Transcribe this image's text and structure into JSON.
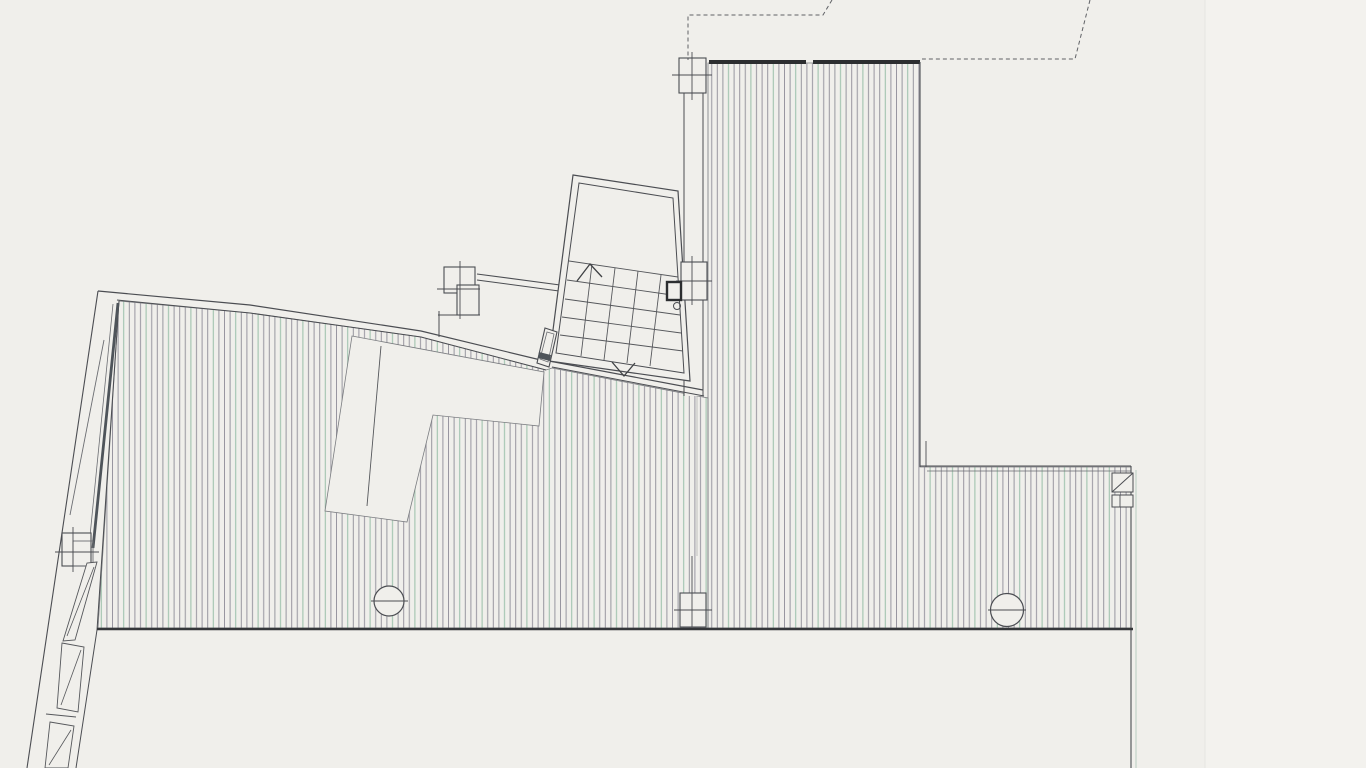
{
  "page": {
    "title": "Scanned architectural floor plan - deck level with stair",
    "background": "#f0efeb",
    "width": 1366,
    "height": 768,
    "visible_text": []
  },
  "palette": {
    "paper": "#f0efeb",
    "paper_right_strip": "#f3f2ee",
    "ink": "#4b4d52",
    "ink_dark": "#2c2e30",
    "ink_soft": "#6b6d72",
    "hatch_gray": "#8e8c97",
    "hatch_green": "#8fb9a1",
    "beam_dark": "#4e545a",
    "dash_line": "#606266",
    "bottom_edge": "#35373a"
  },
  "hatch": {
    "spacing": 5.6,
    "period": 4,
    "green_index": 2,
    "gray": "#8e8c97",
    "green": "#8fb9a1",
    "line_width": 1,
    "opacity": 0.9
  },
  "elements": [
    {
      "n": "paper-right-strip",
      "t": "rect",
      "x": 1205,
      "y": 0,
      "w": 161,
      "h": 768,
      "f": "#f3f2ee"
    },
    {
      "n": "paper-strip-edge",
      "t": "line",
      "pts": [
        1205,
        0,
        1205,
        768
      ],
      "s": "#e6e5e1",
      "sw": 1
    },
    {
      "n": "deck-right-hatch",
      "t": "path",
      "d": "M708,63 L920,63 L920,467 L1131,467 L1131,628 L708,628 Z",
      "f": "url(#hatch)",
      "s": "#7a7c80",
      "sw": 0.8
    },
    {
      "n": "deck-left-hatch",
      "t": "path",
      "d": "M119,301 L250,313 L421,337 L546,370 L552,368 L708,398 L708,628 L98,628 Z M352,336 L544,372 L539,426 L433,415 L407,522 L325,511 Z",
      "f": "url(#hatch)",
      "s": "#7a7c80",
      "sw": 0.8,
      "fr": "evenodd"
    },
    {
      "n": "void-diagonal-line",
      "t": "line",
      "pts": [
        381,
        346,
        367,
        506
      ],
      "s": "#55575b",
      "sw": 0.9
    },
    {
      "n": "mid-wall-cavity",
      "t": "rect",
      "x": 684,
      "y": 62,
      "w": 19,
      "h": 334,
      "f": "#f0efeb"
    },
    {
      "n": "mid-wall-left-line",
      "t": "line",
      "pts": [
        684,
        62,
        684,
        396
      ],
      "s": "#4b4d52",
      "sw": 1
    },
    {
      "n": "mid-wall-right-line",
      "t": "line",
      "pts": [
        703,
        62,
        703,
        396
      ],
      "s": "#4b4d52",
      "sw": 1
    },
    {
      "n": "mid-wall-lower-line",
      "t": "line",
      "pts": [
        697,
        396,
        697,
        556
      ],
      "s": "#7a7c80",
      "sw": 0.7,
      "o": 0.6
    },
    {
      "n": "top-edge-outer-line",
      "t": "pline",
      "pts": [
        98,
        291,
        250,
        305,
        421,
        331,
        549,
        362
      ],
      "s": "#4b4d52",
      "sw": 1.2
    },
    {
      "n": "top-edge-inner-line",
      "t": "pline",
      "pts": [
        117,
        300,
        250,
        313,
        421,
        337,
        546,
        370
      ],
      "s": "#4b4d52",
      "sw": 1
    },
    {
      "n": "stair-bottom-wall-outer",
      "t": "line",
      "pts": [
        549,
        361,
        703,
        390
      ],
      "s": "#4b4d52",
      "sw": 1.2
    },
    {
      "n": "stair-bottom-wall-inner",
      "t": "line",
      "pts": [
        552,
        367,
        704,
        396
      ],
      "s": "#4b4d52",
      "sw": 1
    },
    {
      "n": "left-wall-outer-line",
      "t": "line",
      "pts": [
        98,
        291,
        27,
        768
      ],
      "s": "#4b4d52",
      "sw": 1.1
    },
    {
      "n": "left-wall-inner-line",
      "t": "pline",
      "pts": [
        119,
        301,
        97,
        630,
        76,
        768
      ],
      "s": "#4b4d52",
      "sw": 1
    },
    {
      "n": "left-wall-beam",
      "t": "line",
      "pts": [
        118,
        303,
        93,
        548
      ],
      "s": "#4e545a",
      "sw": 2.8
    },
    {
      "n": "left-wall-beam-edge",
      "t": "line",
      "pts": [
        113,
        304,
        89,
        546
      ],
      "s": "#6b6d72",
      "sw": 0.8
    },
    {
      "n": "left-wall-ramp-line",
      "t": "line",
      "pts": [
        104,
        340,
        70,
        515
      ],
      "s": "#6b6d72",
      "sw": 0.9
    },
    {
      "n": "left-wall-column",
      "t": "rect",
      "x": 62,
      "y": 533,
      "w": 29,
      "h": 33,
      "f": "#f0efeb",
      "s": "#4b4d52",
      "sw": 1.1
    },
    {
      "n": "left-wall-column-inner",
      "t": "rect",
      "x": 73,
      "y": 541,
      "w": 20,
      "h": 25,
      "f": "none",
      "s": "#6b6d72",
      "sw": 0.9
    },
    {
      "n": "left-wall-column-tick-h",
      "t": "line",
      "pts": [
        55,
        552,
        99,
        552
      ],
      "s": "#4b4d52",
      "sw": 0.9
    },
    {
      "n": "left-wall-column-tick-v",
      "t": "line",
      "pts": [
        73,
        527,
        73,
        572
      ],
      "s": "#4b4d52",
      "sw": 0.9
    },
    {
      "n": "left-wall-wedge",
      "t": "poly",
      "pts": "97,562 87,563 63,641 75,640",
      "f": "#f0efeb",
      "s": "#55575b",
      "sw": 0.9
    },
    {
      "n": "left-wall-wedge-diagonal",
      "t": "line",
      "pts": [
        94,
        567,
        67,
        636
      ],
      "s": "#55575b",
      "sw": 0.8
    },
    {
      "n": "left-wall-segment-1",
      "t": "poly",
      "pts": "62,643 84,647 78,712 57,708",
      "f": "#f0efeb",
      "s": "#55575b",
      "sw": 0.9
    },
    {
      "n": "left-wall-segment-1-diagonal",
      "t": "line",
      "pts": [
        81,
        650,
        61,
        705
      ],
      "s": "#55575b",
      "sw": 0.8
    },
    {
      "n": "left-wall-tick",
      "t": "line",
      "pts": [
        46,
        714,
        76,
        717
      ],
      "s": "#55575b",
      "sw": 0.9
    },
    {
      "n": "left-wall-segment-2",
      "t": "poly",
      "pts": "50,722 74,726 68,768 45,768",
      "f": "#f0efeb",
      "s": "#55575b",
      "sw": 0.9
    },
    {
      "n": "left-wall-segment-2-diagonal",
      "t": "line",
      "pts": [
        71,
        730,
        49,
        765
      ],
      "s": "#55575b",
      "sw": 0.8
    },
    {
      "n": "landing-top-wall-outer",
      "t": "line",
      "pts": [
        477,
        274,
        560,
        285
      ],
      "s": "#4b4d52",
      "sw": 1.1
    },
    {
      "n": "landing-top-wall-inner",
      "t": "line",
      "pts": [
        477,
        280,
        559,
        291
      ],
      "s": "#4b4d52",
      "sw": 1
    },
    {
      "n": "landing-left-line",
      "t": "line",
      "pts": [
        439,
        311,
        439,
        337
      ],
      "s": "#4b4d52",
      "sw": 1
    },
    {
      "n": "landing-column-block-a",
      "t": "rect",
      "x": 444,
      "y": 267,
      "w": 31,
      "h": 26,
      "f": "#f0efeb",
      "s": "#4b4d52",
      "sw": 1.1
    },
    {
      "n": "landing-column-block-b",
      "t": "rect",
      "x": 457,
      "y": 285,
      "w": 22,
      "h": 30,
      "f": "#f0efeb",
      "s": "#4b4d52",
      "sw": 1.1
    },
    {
      "n": "landing-column-tick-v",
      "t": "line",
      "pts": [
        460,
        261,
        460,
        319
      ],
      "s": "#4b4d52",
      "sw": 0.9
    },
    {
      "n": "landing-column-tick-h1",
      "t": "line",
      "pts": [
        437,
        289,
        480,
        289
      ],
      "s": "#4b4d52",
      "sw": 0.9
    },
    {
      "n": "landing-column-tick-h2",
      "t": "line",
      "pts": [
        438,
        315,
        480,
        315
      ],
      "s": "#4b4d52",
      "sw": 0.9
    },
    {
      "n": "stair-enclosure-outer",
      "t": "poly",
      "pts": "573,175 678,191 690,381 549,361",
      "f": "#f0efeb",
      "s": "#4b4d52",
      "sw": 1.2
    },
    {
      "n": "stair-enclosure-inner",
      "t": "poly",
      "pts": "579,183 673,198 684,373 556,353",
      "f": "none",
      "s": "#4b4d52",
      "sw": 1
    },
    {
      "n": "stair-tread-1",
      "t": "line",
      "pts": [
        569,
        261,
        678,
        277
      ],
      "s": "#55575b",
      "sw": 0.9
    },
    {
      "n": "stair-tread-2",
      "t": "line",
      "pts": [
        567,
        280,
        679,
        296
      ],
      "s": "#55575b",
      "sw": 0.9
    },
    {
      "n": "stair-tread-3",
      "t": "line",
      "pts": [
        565,
        299,
        680,
        315
      ],
      "s": "#55575b",
      "sw": 0.9
    },
    {
      "n": "stair-tread-4",
      "t": "line",
      "pts": [
        562,
        317,
        681,
        333
      ],
      "s": "#55575b",
      "sw": 0.9
    },
    {
      "n": "stair-tread-5",
      "t": "line",
      "pts": [
        560,
        335,
        683,
        351
      ],
      "s": "#55575b",
      "sw": 0.9
    },
    {
      "n": "stair-riser-1",
      "t": "line",
      "pts": [
        592,
        264,
        581,
        356
      ],
      "s": "#55575b",
      "sw": 0.9
    },
    {
      "n": "stair-riser-2",
      "t": "line",
      "pts": [
        615,
        268,
        604,
        360
      ],
      "s": "#55575b",
      "sw": 0.9
    },
    {
      "n": "stair-riser-3",
      "t": "line",
      "pts": [
        638,
        271,
        627,
        363
      ],
      "s": "#55575b",
      "sw": 0.9
    },
    {
      "n": "stair-riser-4",
      "t": "line",
      "pts": [
        661,
        275,
        650,
        366
      ],
      "s": "#55575b",
      "sw": 0.9
    },
    {
      "n": "stair-up-arrow",
      "t": "pline",
      "pts": [
        577,
        281,
        590,
        264,
        602,
        277
      ],
      "s": "#3f4144",
      "sw": 1.3
    },
    {
      "n": "stair-down-arrow",
      "t": "pline",
      "pts": [
        612,
        362,
        624,
        376,
        635,
        363
      ],
      "s": "#3f4144",
      "sw": 1.3
    },
    {
      "n": "mid-column-top",
      "t": "rect",
      "x": 679,
      "y": 58,
      "w": 27,
      "h": 35,
      "f": "#f0efeb",
      "s": "#4b4d52",
      "sw": 1.1
    },
    {
      "n": "mid-column-top-tick-h",
      "t": "line",
      "pts": [
        672,
        75,
        712,
        75
      ],
      "s": "#4b4d52",
      "sw": 0.9
    },
    {
      "n": "mid-column-top-tick-v",
      "t": "line",
      "pts": [
        692,
        52,
        692,
        100
      ],
      "s": "#4b4d52",
      "sw": 0.9
    },
    {
      "n": "mid-column-middle",
      "t": "rect",
      "x": 681,
      "y": 262,
      "w": 26,
      "h": 38,
      "f": "#f0efeb",
      "s": "#4b4d52",
      "sw": 1.1
    },
    {
      "n": "mid-column-middle-tick-h",
      "t": "line",
      "pts": [
        676,
        281,
        712,
        281
      ],
      "s": "#4b4d52",
      "sw": 0.9
    },
    {
      "n": "mid-column-middle-tick-v",
      "t": "line",
      "pts": [
        692,
        256,
        692,
        305
      ],
      "s": "#4b4d52",
      "sw": 0.9
    },
    {
      "n": "stair-door-frame",
      "t": "rect",
      "x": 667,
      "y": 282,
      "w": 14,
      "h": 18,
      "f": "#f0efeb",
      "s": "#2c2e30",
      "sw": 2.4
    },
    {
      "n": "door-pivot-circle",
      "t": "circle",
      "cx": 677,
      "cy": 306,
      "r": 3.5,
      "f": "none",
      "s": "#4b4d52",
      "sw": 1
    },
    {
      "n": "mid-column-bottom",
      "t": "rect",
      "x": 680,
      "y": 593,
      "w": 26,
      "h": 34,
      "f": "#f0efeb",
      "s": "#4b4d52",
      "sw": 1.1
    },
    {
      "n": "mid-column-bottom-tick-h",
      "t": "line",
      "pts": [
        674,
        610,
        712,
        610
      ],
      "s": "#4b4d52",
      "sw": 0.9
    },
    {
      "n": "mid-column-bottom-tick-v",
      "t": "line",
      "pts": [
        692,
        556,
        692,
        627
      ],
      "s": "#4b4d52",
      "sw": 0.9
    },
    {
      "n": "deck-right-top-band-a",
      "t": "line",
      "pts": [
        709,
        62,
        806,
        62
      ],
      "s": "#2c2e30",
      "sw": 4
    },
    {
      "n": "deck-right-top-band-b",
      "t": "line",
      "pts": [
        813,
        62,
        920,
        62
      ],
      "s": "#2c2e30",
      "sw": 4
    },
    {
      "n": "deck-right-edge-line",
      "t": "line",
      "pts": [
        920,
        62,
        920,
        467
      ],
      "s": "#4b4d52",
      "sw": 1.1
    },
    {
      "n": "ext-corner-step-line",
      "t": "line",
      "pts": [
        926,
        441,
        926,
        467
      ],
      "s": "#4b4d52",
      "sw": 0.9
    },
    {
      "n": "ext-top-line-outer",
      "t": "line",
      "pts": [
        920,
        466,
        1131,
        466
      ],
      "s": "#4b4d52",
      "sw": 1.1
    },
    {
      "n": "ext-top-line-inner",
      "t": "line",
      "pts": [
        927,
        471,
        1131,
        471
      ],
      "s": "#6b6d72",
      "sw": 0.8
    },
    {
      "n": "ext-right-edge-line",
      "t": "line",
      "pts": [
        1131,
        466,
        1131,
        768
      ],
      "s": "#4b4d52",
      "sw": 1.1
    },
    {
      "n": "ext-right-edge-tint-line",
      "t": "line",
      "pts": [
        1136,
        470,
        1136,
        768
      ],
      "s": "#9fbfae",
      "sw": 1,
      "o": 0.7
    },
    {
      "n": "ext-corner-box",
      "t": "rect",
      "x": 1112,
      "y": 473,
      "w": 21,
      "h": 19,
      "f": "#f0efeb",
      "s": "#4b4d52",
      "sw": 1
    },
    {
      "n": "ext-corner-box-diagonal",
      "t": "line",
      "pts": [
        1112,
        492,
        1133,
        473
      ],
      "s": "#4b4d52",
      "sw": 1
    },
    {
      "n": "ext-corner-box-2",
      "t": "rect",
      "x": 1112,
      "y": 495,
      "w": 21,
      "h": 12,
      "f": "#f0efeb",
      "s": "#4b4d52",
      "sw": 1
    },
    {
      "n": "ext-corner-box-2-divider",
      "t": "line",
      "pts": [
        1120,
        495,
        1120,
        507
      ],
      "s": "#4b4d52",
      "sw": 0.9
    },
    {
      "n": "bottom-edge-line",
      "t": "line",
      "pts": [
        97,
        629,
        1133,
        629
      ],
      "s": "#35373a",
      "sw": 2.6
    },
    {
      "n": "column-circle-left",
      "t": "circle",
      "cx": 389,
      "cy": 601,
      "r": 15,
      "f": "#f0efeb",
      "s": "#4b4d52",
      "sw": 1.2
    },
    {
      "n": "column-circle-left-axis",
      "t": "line",
      "pts": [
        371,
        601,
        408,
        601
      ],
      "s": "#4b4d52",
      "sw": 1
    },
    {
      "n": "column-circle-right",
      "t": "circle",
      "cx": 1007,
      "cy": 610,
      "r": 16.5,
      "f": "#f0efeb",
      "s": "#4b4d52",
      "sw": 1.2
    },
    {
      "n": "column-circle-right-axis",
      "t": "line",
      "pts": [
        988,
        610,
        1026,
        610
      ],
      "s": "#4b4d52",
      "sw": 1
    },
    {
      "n": "landing-door-jamb",
      "t": "poly",
      "pts": "545,328 557,332 549,367 537,363",
      "f": "#f0efeb",
      "s": "#4b4d52",
      "sw": 1.1
    },
    {
      "n": "landing-door-jamb-inner",
      "t": "poly",
      "pts": "547,332 554,334 548,362 540,359",
      "f": "none",
      "s": "#6b6d72",
      "sw": 0.8
    },
    {
      "n": "landing-door-jamb-band",
      "t": "poly",
      "pts": "539,352 551,355 550,361 538,358",
      "f": "#4e545a"
    },
    {
      "n": "roof-outline-dashed-left",
      "t": "pline",
      "pts": [
        832,
        0,
        823,
        15,
        688,
        15,
        688,
        60
      ],
      "s": "#606266",
      "sw": 1,
      "dash": "4 3"
    },
    {
      "n": "roof-outline-dashed-right",
      "t": "pline",
      "pts": [
        1090,
        0,
        1075,
        59,
        922,
        59
      ],
      "s": "#606266",
      "sw": 1,
      "dash": "4 3"
    }
  ]
}
